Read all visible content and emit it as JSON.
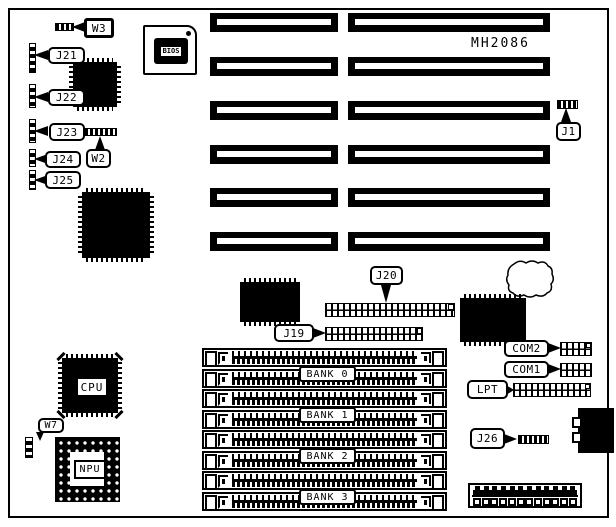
{
  "diagram": {
    "title": "MH2086"
  },
  "labels": {
    "w3": "W3",
    "j21": "J21",
    "j22": "J22",
    "j23": "J23",
    "w2": "W2",
    "j24": "J24",
    "j25": "J25",
    "j1": "J1",
    "j20": "J20",
    "j19": "J19",
    "com2": "COM2",
    "com1": "COM1",
    "lpt": "LPT",
    "j26": "J26",
    "w7": "W7"
  },
  "chips": {
    "bios": "BIOS",
    "cpu": "CPU",
    "npu": "NPU"
  },
  "memory_banks": [
    {
      "label": "BANK 0"
    },
    {
      "label": "BANK 1"
    },
    {
      "label": "BANK 2"
    },
    {
      "label": "BANK 3"
    }
  ],
  "colors": {
    "ink": "#000000",
    "paper": "#ffffff"
  }
}
